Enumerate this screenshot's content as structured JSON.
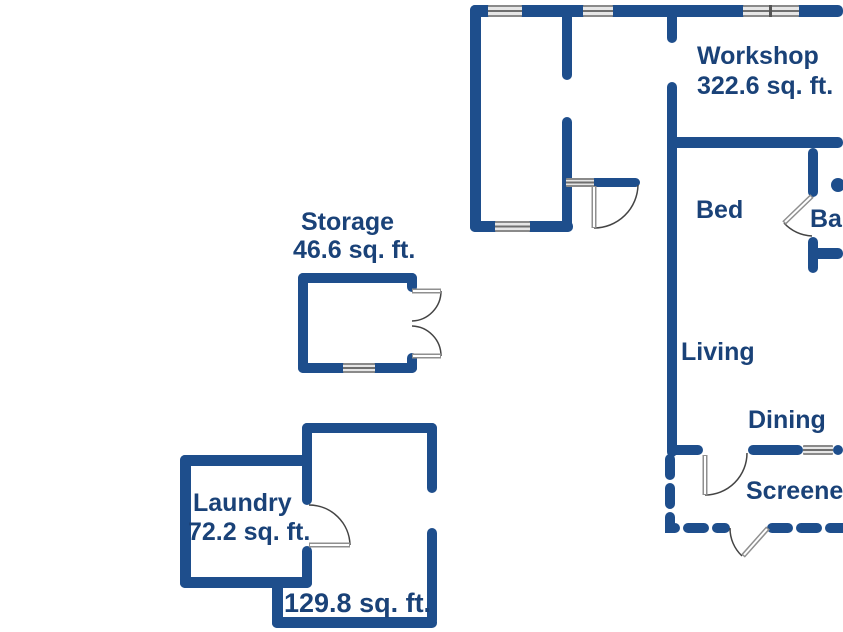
{
  "colors": {
    "wall": "#1e4e8c",
    "label_text": "#1a4278",
    "window": "#e6e6e6",
    "door": "#8f8f8f",
    "background": "#ffffff"
  },
  "rooms": {
    "workshop": {
      "label": "Workshop",
      "area": "322.6 sq. ft."
    },
    "storage": {
      "label": "Storage",
      "area": "46.6 sq. ft."
    },
    "bed": {
      "label": "Bed"
    },
    "bath": {
      "label": "Ba"
    },
    "living": {
      "label": "Living"
    },
    "dining": {
      "label": "Dining"
    },
    "screened_porch": {
      "label": "Screene"
    },
    "laundry": {
      "label": "Laundry",
      "area": "72.2 sq. ft."
    },
    "bonus_room": {
      "area": "129.8 sq. ft."
    }
  }
}
